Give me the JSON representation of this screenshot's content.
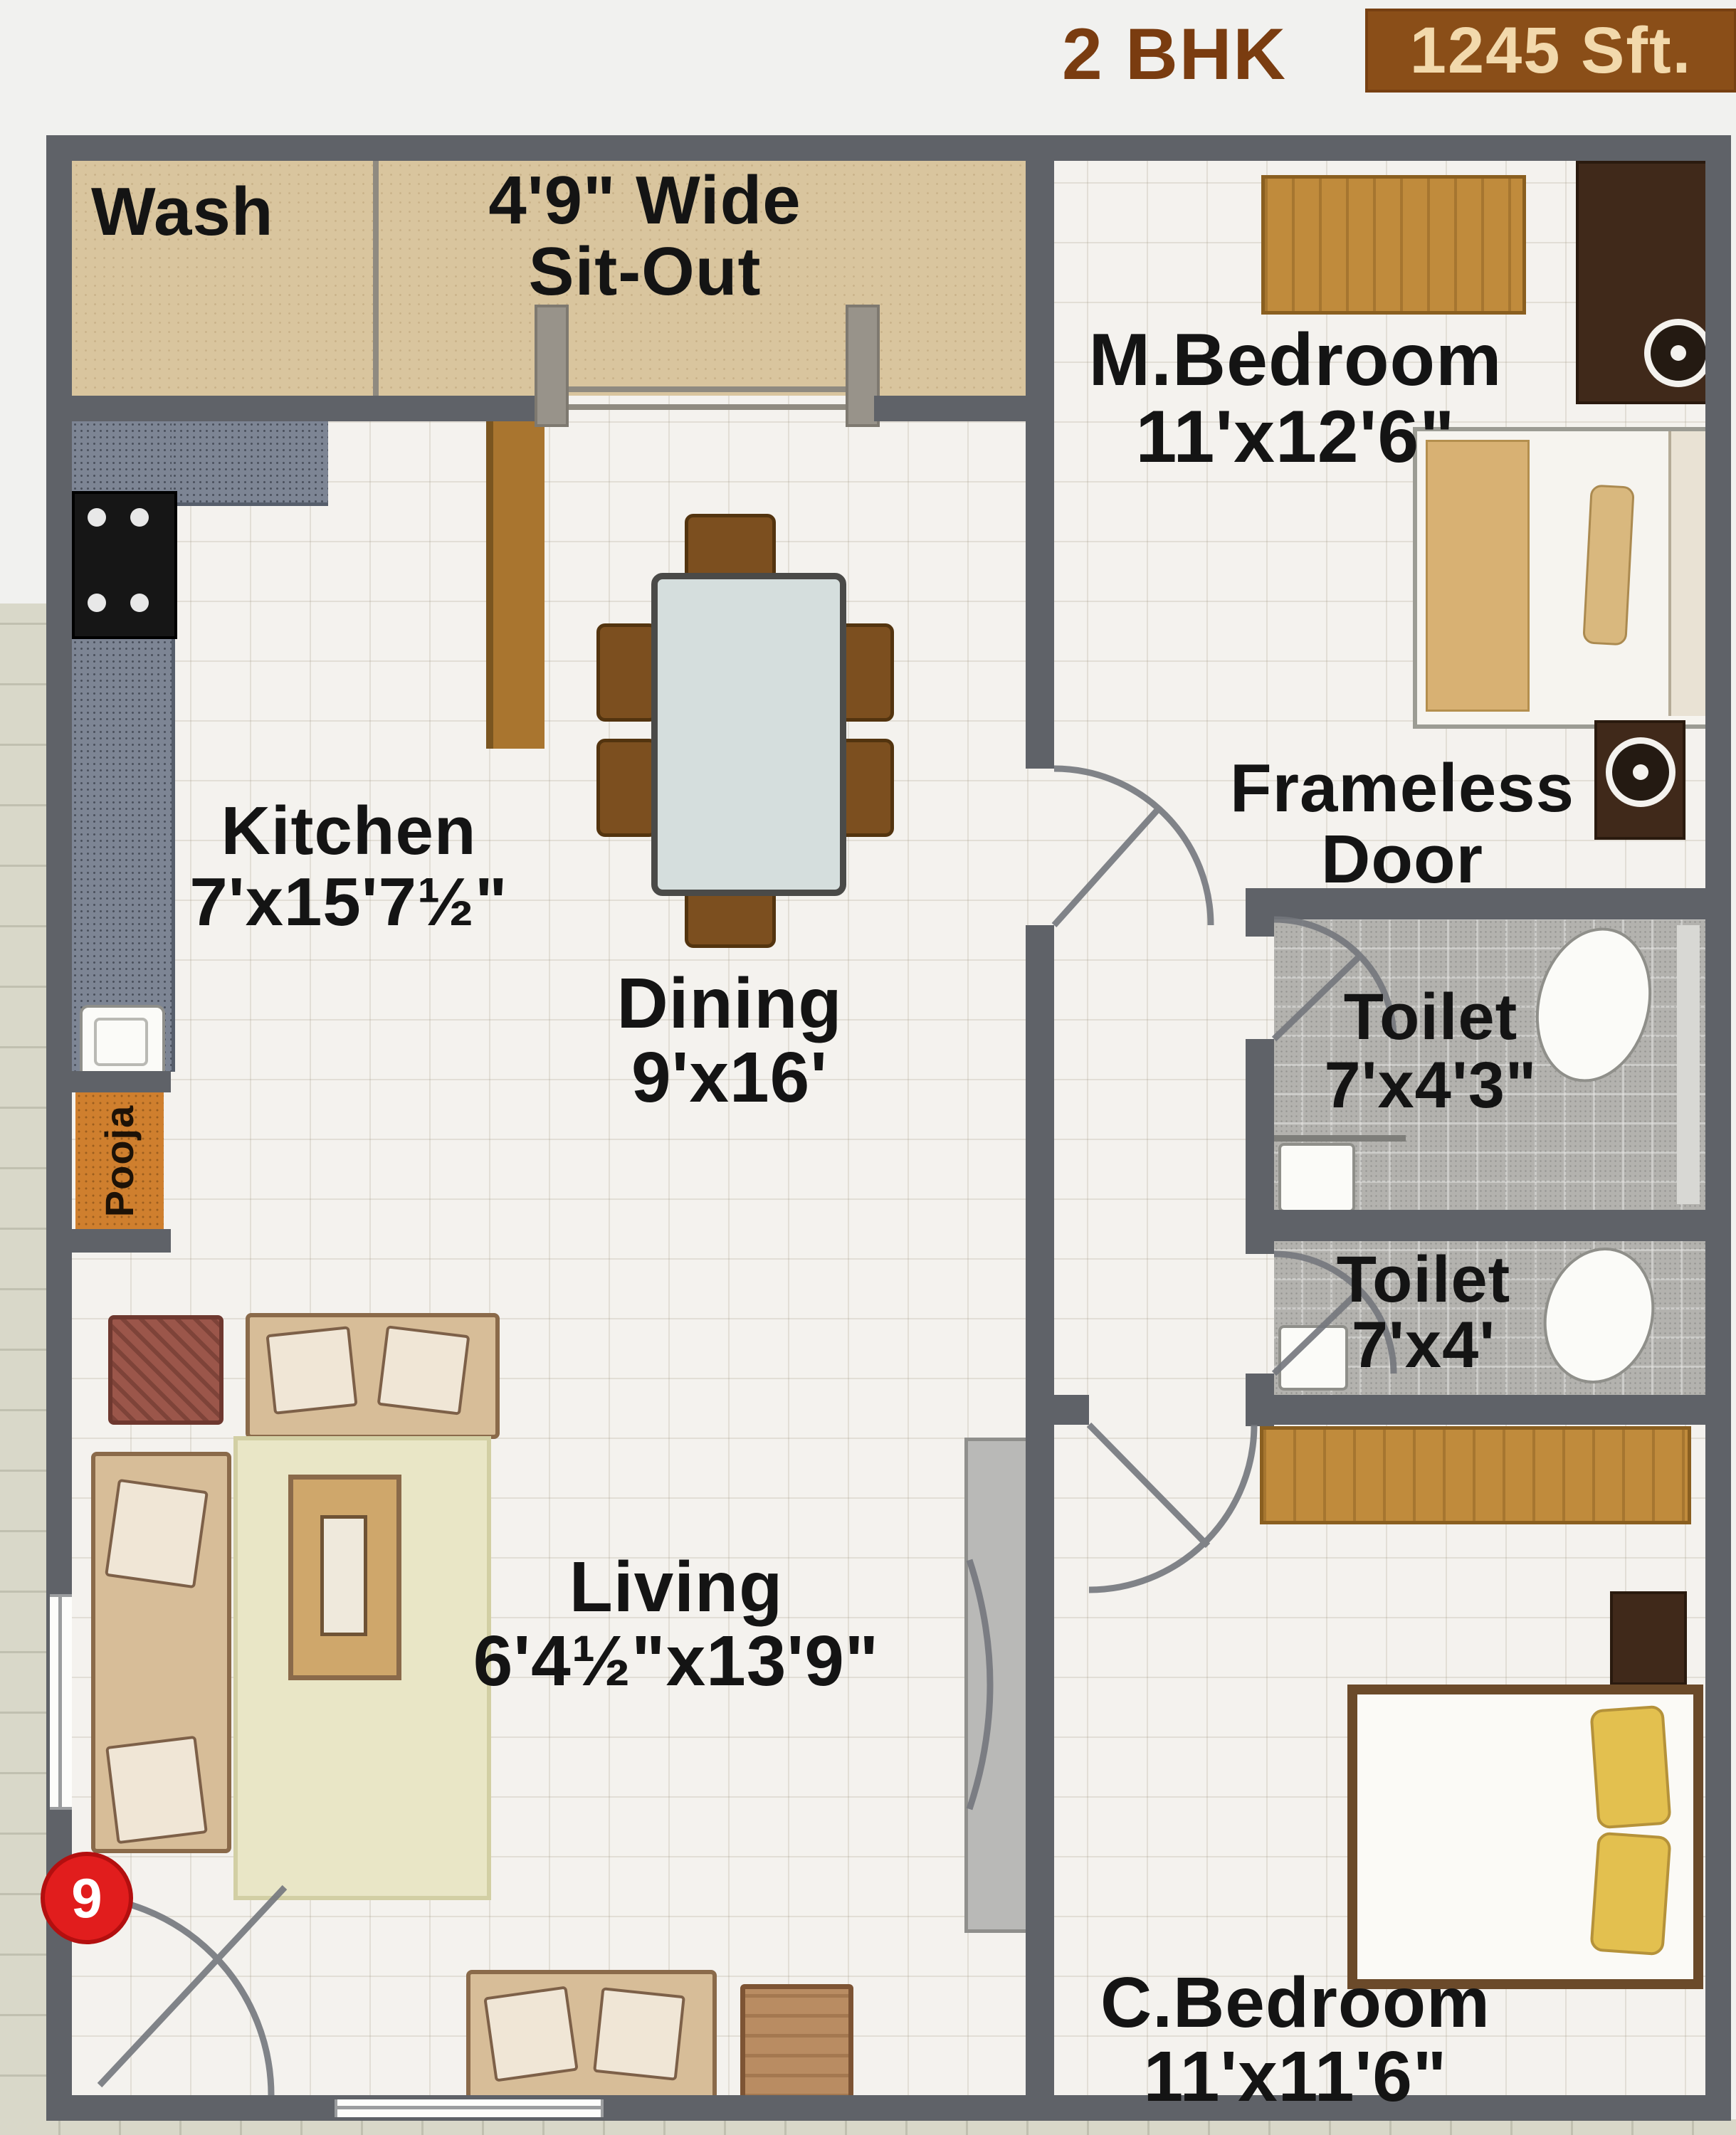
{
  "header": {
    "type_label": "2 BHK",
    "area_label": "1245 Sft."
  },
  "rooms": {
    "wash": {
      "label": "Wash"
    },
    "sitout": {
      "line1": "4'9\" Wide",
      "line2": "Sit-Out"
    },
    "master_bedroom": {
      "name": "M.Bedroom",
      "dims": "11'x12'6\""
    },
    "frameless_door": {
      "line1": "Frameless",
      "line2": "Door"
    },
    "toilet1": {
      "name": "Toilet",
      "dims": "7'x4'3\""
    },
    "toilet2": {
      "name": "Toilet",
      "dims": "7'x4'"
    },
    "kitchen": {
      "name": "Kitchen",
      "dims": "7'x15'7½\""
    },
    "dining": {
      "name": "Dining",
      "dims": "9'x16'"
    },
    "living": {
      "name": "Living",
      "dims": "6'4½\"x13'9\""
    },
    "child_bedroom": {
      "name": "C.Bedroom",
      "dims": "11'x11'6\""
    },
    "pooja": {
      "label": "Pooja"
    }
  },
  "marker": {
    "number": "9"
  },
  "colors": {
    "wall": "#5f6268",
    "accent_brown": "#8a4e18",
    "header_text_brown": "#7a3c10",
    "marker_red": "#e11d1d",
    "sitout_tan": "#d9c59e",
    "granite_gray": "#7d8594",
    "toilet_tile": "#b3b2ae"
  }
}
